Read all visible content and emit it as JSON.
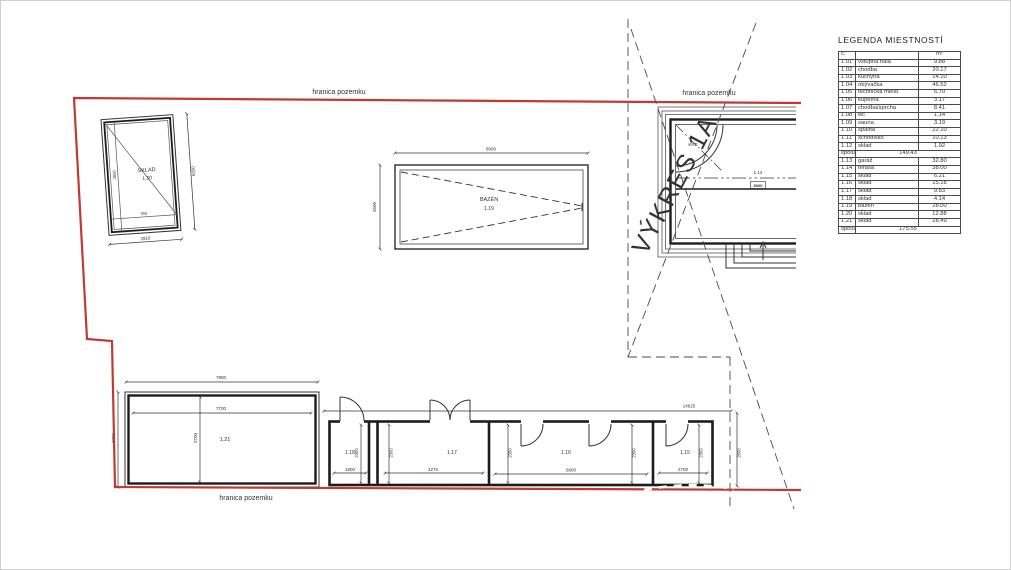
{
  "labels": {
    "boundary_top_left": "hranica pozemku",
    "boundary_top_right": "hranica pozemku",
    "boundary_bottom": "hranica pozemku",
    "vykres": "VÝKRES 1A"
  },
  "colors": {
    "boundary_red": "#c13a31",
    "line_dark": "#2b2b2b"
  },
  "sklad": {
    "name": "SKLAD",
    "no": "1.20",
    "dim_bottom": "3910",
    "dim_right": "6350",
    "dim_inner_left": "2850",
    "dim_inner_bottom": "760"
  },
  "pool": {
    "name": "BAZÉN",
    "no": "1.19",
    "dim_top": "8000",
    "dim_left": "3500"
  },
  "house": {
    "krb": "KRB",
    "terasa_no": "1.14",
    "terasa_dim": "8000"
  },
  "b121": {
    "no": "1.21",
    "dim_top": "7800",
    "dim_inner": "7700",
    "dim_left": "3800",
    "dim_mid": "3700"
  },
  "strip": {
    "dim_top": "14625",
    "dim_right": "2600",
    "rooms": [
      {
        "no": "1.18",
        "dim_bottom": "1800",
        "dim_side": "2300"
      },
      {
        "no": "1.17",
        "dim_bottom": "4275",
        "dim_side": "2300"
      },
      {
        "no": "1.16",
        "dim_bottom": "6600",
        "dim_side": "2300"
      },
      {
        "no": "1.15",
        "dim_bottom": "2700",
        "dim_side": "2300"
      }
    ]
  },
  "legend": {
    "title": "LEGENDA MIESTNOSTÍ",
    "header": {
      "no": "č.",
      "name": "",
      "area": "m²"
    },
    "rows": [
      {
        "no": "1.01",
        "name": "vstupná hala",
        "area": "9.88"
      },
      {
        "no": "1.02",
        "name": "chodba",
        "area": "20.17"
      },
      {
        "no": "1.03",
        "name": "kuchyňa",
        "area": "14.10"
      },
      {
        "no": "1.04",
        "name": "obývačka",
        "area": "46.52"
      },
      {
        "no": "1.05",
        "name": "technická miest.",
        "area": "6.70"
      },
      {
        "no": "1.06",
        "name": "kúpeľňa",
        "area": "3.17"
      },
      {
        "no": "1.07",
        "name": "chodba/sprcha",
        "area": "8.41"
      },
      {
        "no": "1.08",
        "name": "wc",
        "area": "1.14"
      },
      {
        "no": "1.09",
        "name": "sauna",
        "area": "3.19"
      },
      {
        "no": "1.10",
        "name": "spálňa",
        "area": "22.10"
      },
      {
        "no": "1.11",
        "name": "schodisko",
        "area": "10.13"
      },
      {
        "no": "1.12",
        "name": "sklad",
        "area": "1.92"
      },
      {
        "kind": "subtotal",
        "no": "spolu",
        "area": "149.43"
      },
      {
        "no": "1.13",
        "name": "garáž",
        "area": "32.80"
      },
      {
        "no": "1.14",
        "name": "terasa",
        "area": "38.00"
      },
      {
        "no": "1.15",
        "name": "sklad",
        "area": "6.21"
      },
      {
        "no": "1.16",
        "name": "sklad",
        "area": "15.18"
      },
      {
        "no": "1.17",
        "name": "sklad",
        "area": "9.83"
      },
      {
        "no": "1.18",
        "name": "sklad",
        "area": "4.14"
      },
      {
        "no": "1.19",
        "name": "bazén",
        "area": "28.00"
      },
      {
        "no": "1.20",
        "name": "sklad",
        "area": "12.88"
      },
      {
        "no": "1.21",
        "name": "sklad",
        "area": "28.49"
      },
      {
        "kind": "subtotal",
        "no": "spolu",
        "area": "175.55"
      }
    ]
  }
}
